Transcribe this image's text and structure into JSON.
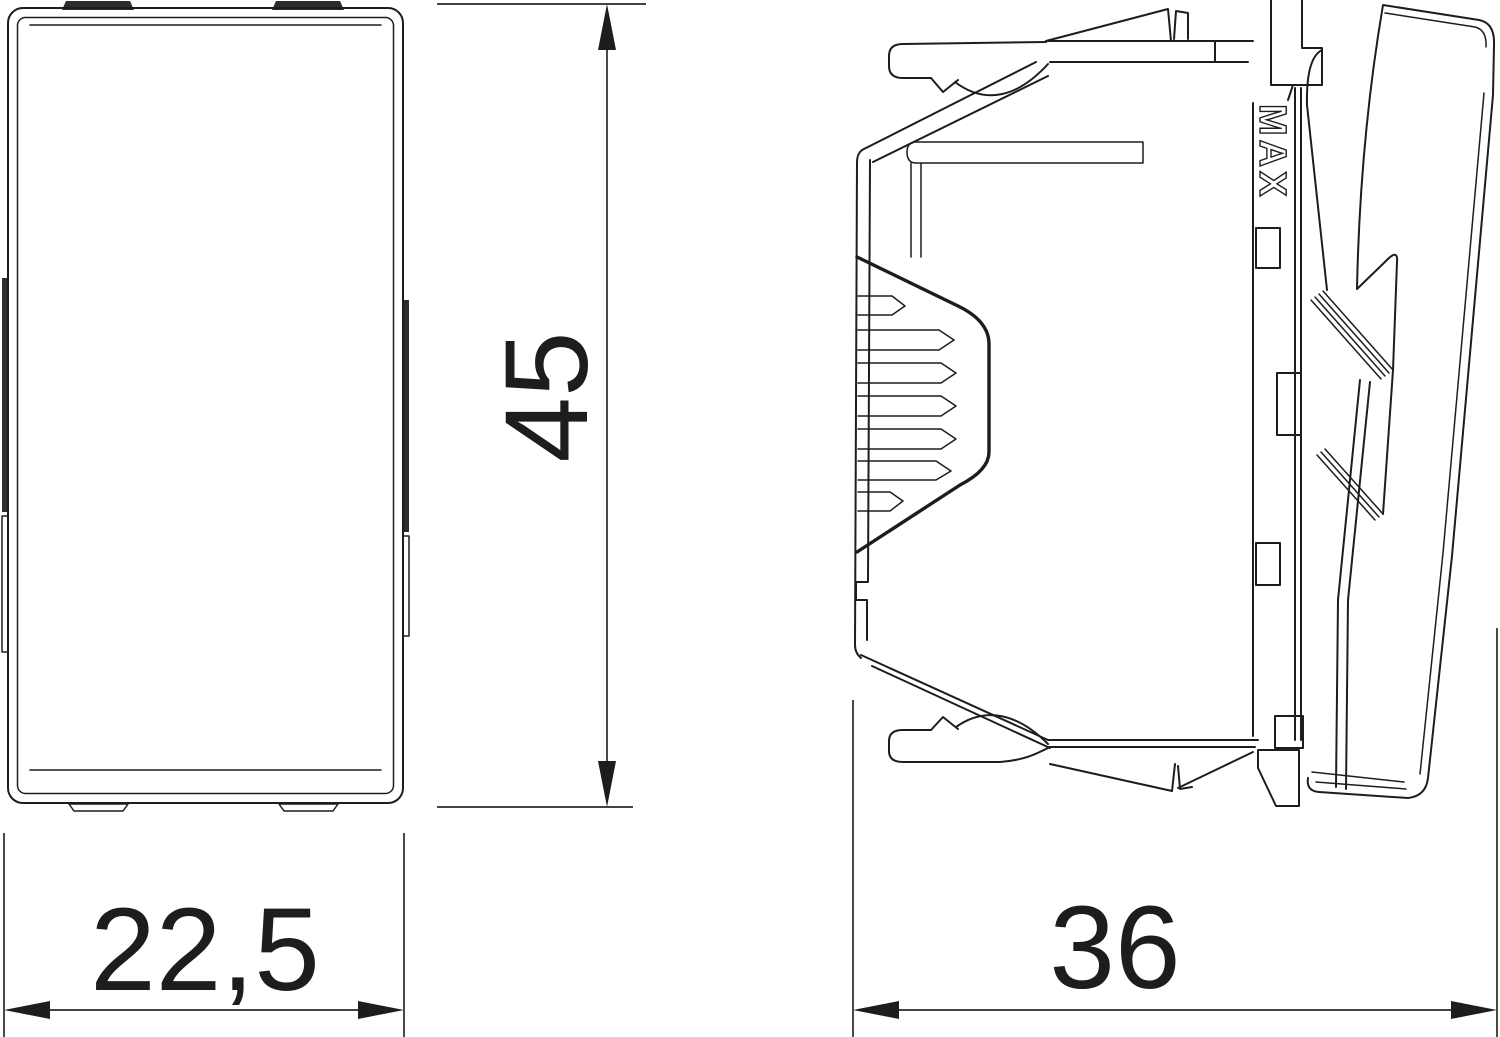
{
  "drawing": {
    "background_color": "#ffffff",
    "line_color": "#1d1d1d",
    "kind": "technical dimension drawing, front and side view of rocker switch module"
  },
  "dimensions": {
    "width": "22,5",
    "height": "45",
    "depth": "36"
  },
  "markings": {
    "max_label": "MAX"
  }
}
